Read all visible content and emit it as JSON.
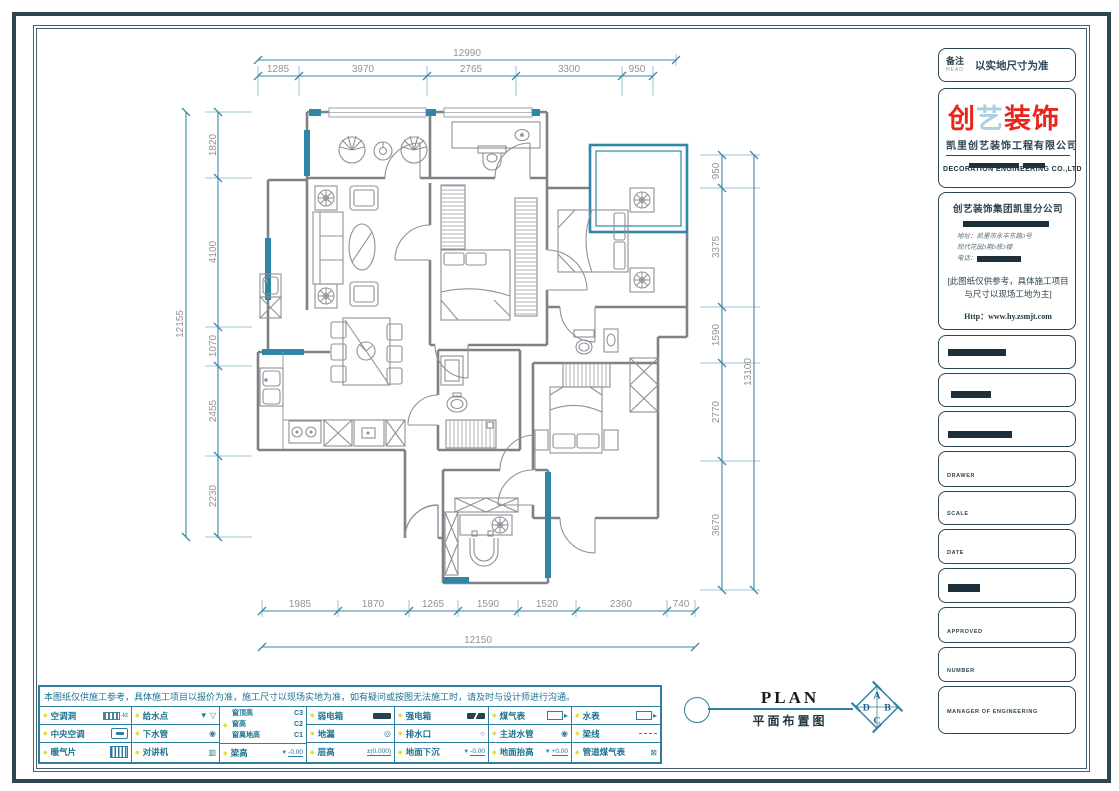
{
  "sheet": {
    "note_label": "备注",
    "note_sub": "HEAD",
    "note_value": "以实地尺寸为准"
  },
  "brand": {
    "logo_char1": "创",
    "logo_char2": "艺",
    "logo_rest": "装饰",
    "company_cn": "凯里创艺装饰工程有限公司",
    "company_en": "DECORATION ENGINEERING CO.,LTD",
    "branch": "创艺装饰集团凯里分公司",
    "address_line1": "地址：凯里市永丰东路3号",
    "address_line2": "现代花园3期3栋3楼",
    "phone_label": "电话：",
    "notice": "[此图纸仅供参考，具体施工项目与尺寸以现场工地为主]",
    "website": "Http：www.hy.zsmjt.com"
  },
  "fields": [
    {
      "label": ""
    },
    {
      "label": ""
    },
    {
      "label": ""
    },
    {
      "label": "DRAWER"
    },
    {
      "label": "SCALE"
    },
    {
      "label": "DATE"
    },
    {
      "label": ""
    },
    {
      "label": "APPROVED"
    },
    {
      "label": "NUMBER"
    },
    {
      "label": "MANAGER OF ENGINEERING"
    }
  ],
  "dims": {
    "top": {
      "total": "12990",
      "segs": [
        "1285",
        "3970",
        "2765",
        "3300",
        "950"
      ]
    },
    "left": {
      "total": "12155",
      "segs": [
        "1820",
        "4100",
        "1070",
        "2455",
        "2230"
      ]
    },
    "right": {
      "total": "13100",
      "segs": [
        "950",
        "3375",
        "1590",
        "2770",
        "3670"
      ]
    },
    "bottom": {
      "total": "12150",
      "segs": [
        "1985",
        "1870",
        "1265",
        "1590",
        "1520",
        "2360",
        "740"
      ]
    }
  },
  "plan_title": {
    "en": "PLAN",
    "cn": "平面布置图",
    "compass": {
      "top": "A",
      "right": "B",
      "bottom": "C",
      "left": "D"
    }
  },
  "footer": {
    "disclaimer": "本图纸仅供施工参考，具体施工项目以报价为准，施工尺寸以现场实地为准，如有疑问或按图无法施工时，请及时与设计师进行沟通。",
    "legend": {
      "c1": [
        {
          "label": "空调洞",
          "suffix": "-kt"
        },
        {
          "label": "中央空调"
        },
        {
          "label": "暖气片"
        }
      ],
      "c2": [
        {
          "label": "给水点"
        },
        {
          "label": "下水管"
        },
        {
          "label": "对讲机"
        }
      ],
      "c3": {
        "win": [
          {
            "label": "窗顶高",
            "code": "C3"
          },
          {
            "label": "窗高",
            "code": "C2"
          },
          {
            "label": "窗离地高",
            "code": "C1"
          }
        ],
        "beam": {
          "label": "梁高",
          "value": "-0.00"
        }
      },
      "c4": [
        {
          "label": "弱电箱"
        },
        {
          "label": "地漏"
        },
        {
          "label": "层高",
          "value": "±(0.000)"
        }
      ],
      "c5": [
        {
          "label": "强电箱"
        },
        {
          "label": "排水口"
        },
        {
          "label": "地面下沉",
          "value": "-0.00"
        }
      ],
      "c6": [
        {
          "label": "煤气表"
        },
        {
          "label": "主进水管"
        },
        {
          "label": "地面抬高",
          "value": "+0.00"
        }
      ],
      "c7": [
        {
          "label": "水表"
        },
        {
          "label": "梁线"
        },
        {
          "label": "管道煤气表"
        }
      ]
    }
  }
}
